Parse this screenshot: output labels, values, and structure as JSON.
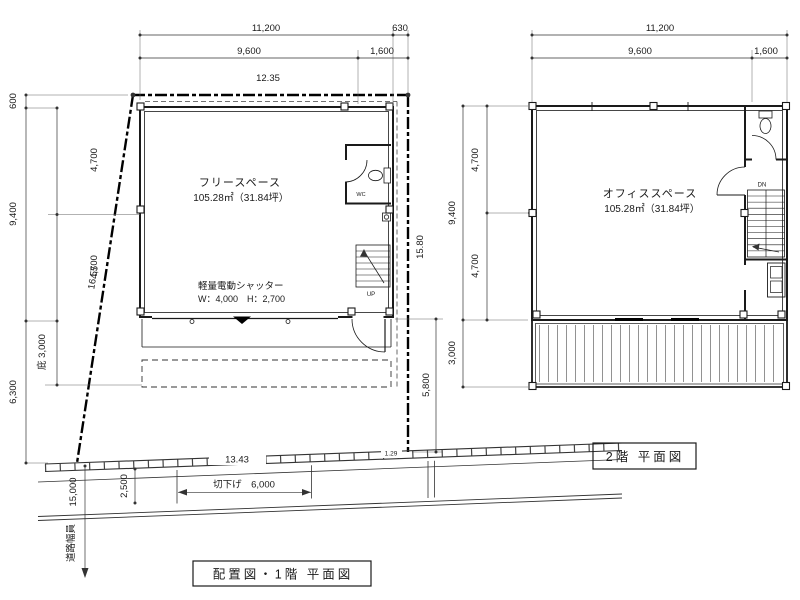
{
  "left_plan": {
    "title": "配置図・1階 平面図",
    "room_name": "フリースペース",
    "room_area": "105.28㎡（31.84坪）",
    "shutter_label": "軽量電動シャッター",
    "shutter_size": "W：4,000　H：2,700",
    "stair_direction": "UP",
    "wc_label": "WC",
    "dims": {
      "top_total": "11,200",
      "top_offset": "630",
      "top_main": "9,600",
      "top_sub": "1,600",
      "site_top": "12.35",
      "site_left": "16.55",
      "site_right": "15.80",
      "site_bottom": "13.43",
      "site_bottom_small": "1.29",
      "left_600": "600",
      "left_9400": "9,400",
      "left_6300": "6,300",
      "inner_4700_a": "4,700",
      "inner_4700_b": "4,700",
      "eave_3000": "庇 3,000",
      "right_5800": "5,800",
      "road_15000": "15,000",
      "road_2500": "2,500",
      "curb_cut_6000": "切下げ　6,000",
      "road_width_label": "道路幅員"
    }
  },
  "right_plan": {
    "title": "2階 平面図",
    "room_name": "オフィススペース",
    "room_area": "105.28㎡（31.84坪）",
    "stair_direction": "DN",
    "dims": {
      "top_total": "11,200",
      "top_main": "9,600",
      "top_sub": "1,600",
      "left_9400": "9,400",
      "inner_4700_a": "4,700",
      "inner_4700_b": "4,700",
      "left_3000": "3,000"
    }
  }
}
